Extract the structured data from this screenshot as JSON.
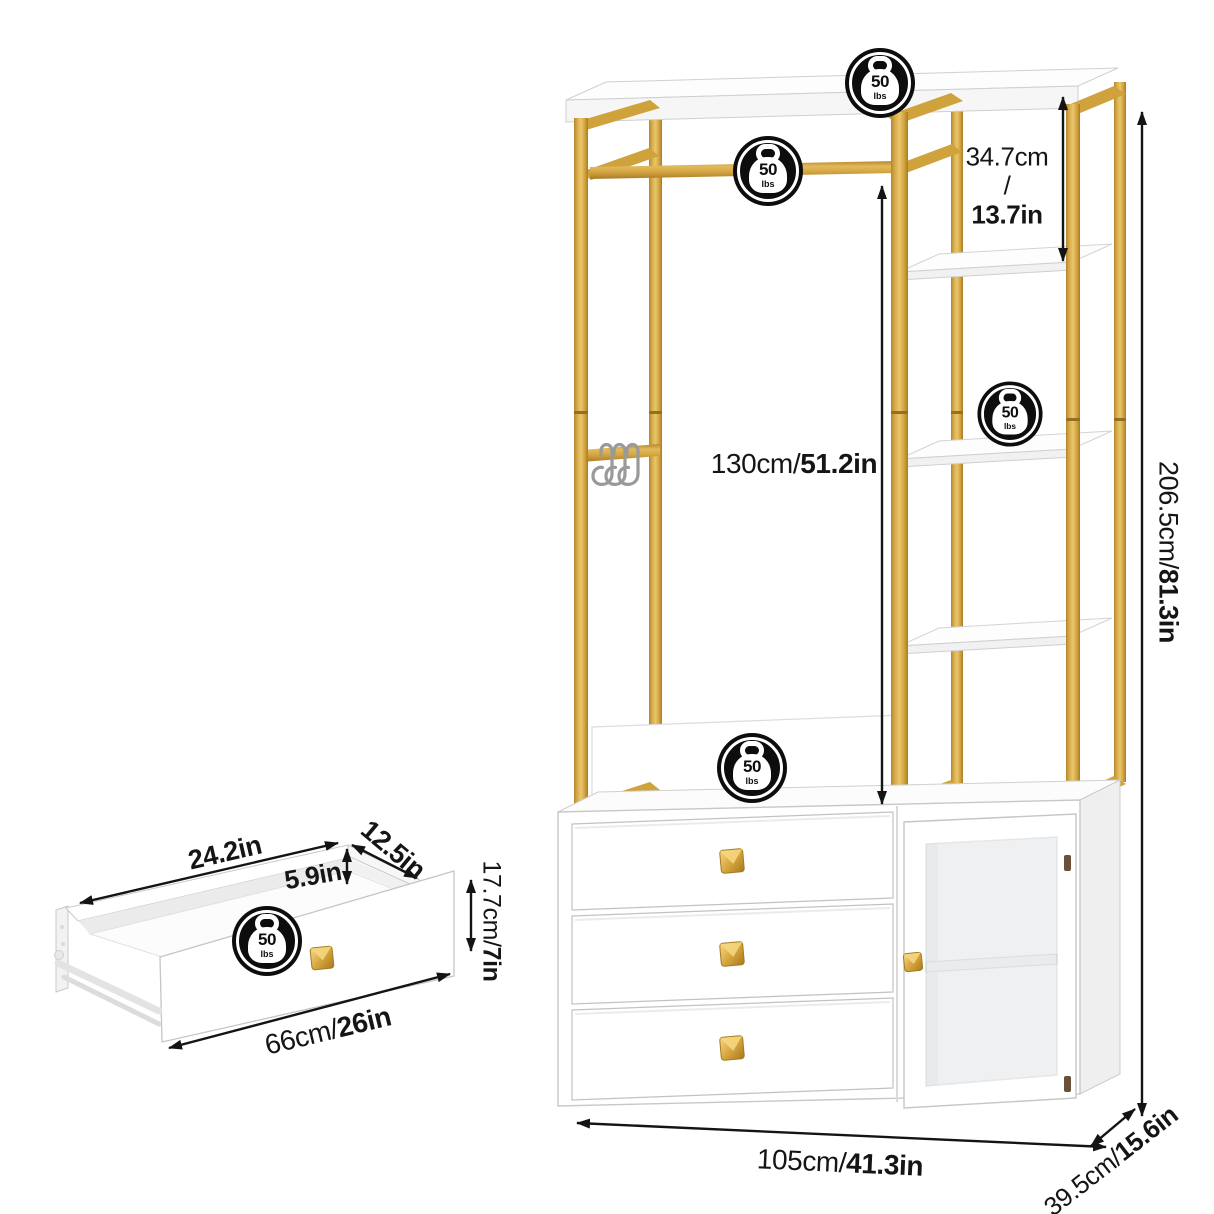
{
  "diagram": {
    "weight_badge": {
      "value": "50",
      "unit": "lbs"
    },
    "main_unit": {
      "shelf_spacing_cm": "34.7cm",
      "shelf_spacing_sep": "/",
      "shelf_spacing_in": "13.7in",
      "hanging_height_cm": "130cm/",
      "hanging_height_in": "51.2in",
      "total_height_cm": "206.5cm/",
      "total_height_in": "81.3in",
      "width_cm": "105cm/",
      "width_in": "41.3in",
      "depth_cm": "39.5cm/",
      "depth_in": "15.6in"
    },
    "drawer": {
      "inner_width_in": "24.2in",
      "depth_in": "12.5in",
      "inner_height_in": "5.9in",
      "front_height_cm": "17.7cm/",
      "front_height_in": "7in",
      "outer_width_cm": "66cm/",
      "outer_width_in": "26in"
    },
    "colors": {
      "gold": "#d4a343",
      "white": "#ffffff",
      "black": "#141414"
    }
  }
}
